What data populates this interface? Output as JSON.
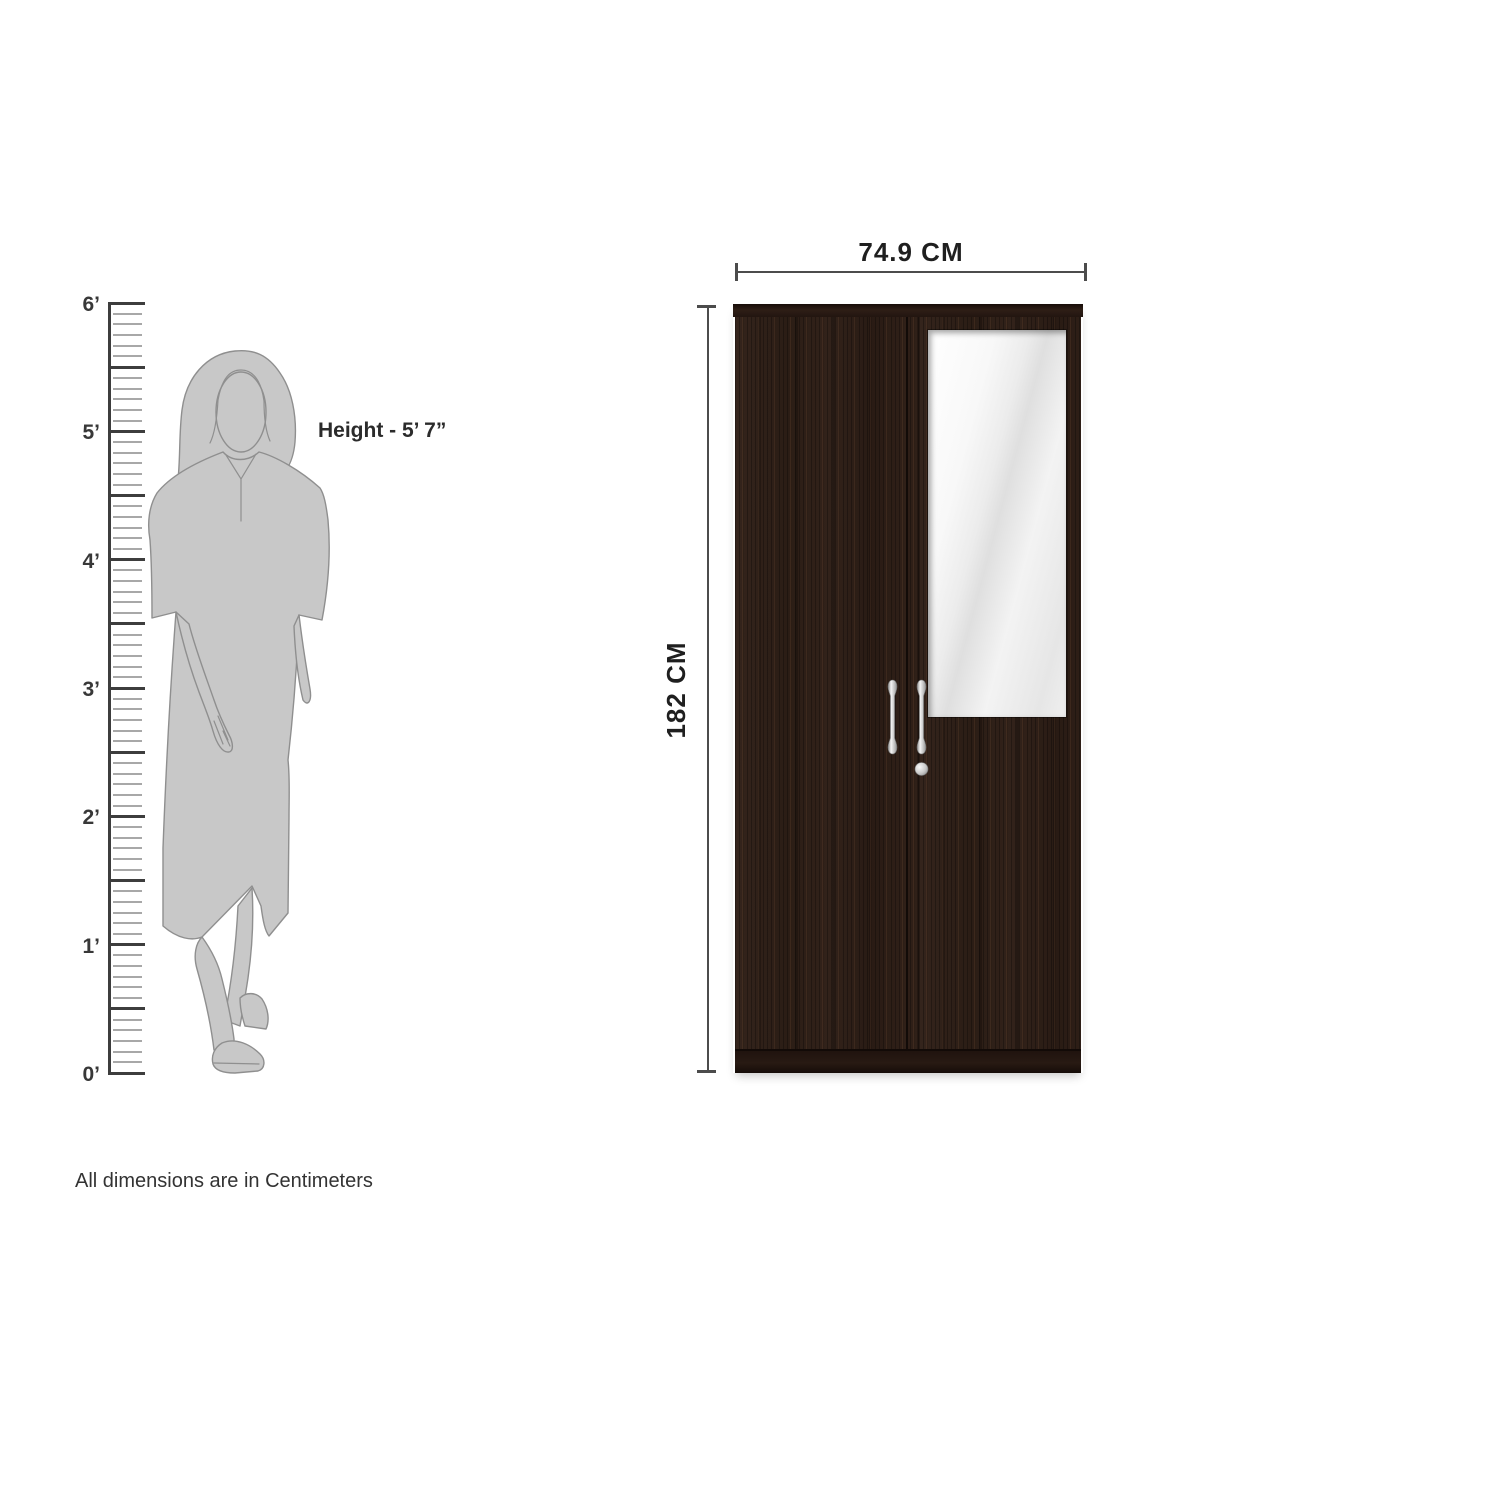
{
  "scale_reference": {
    "ruler": {
      "foot_labels": [
        "6’",
        "5’",
        "4’",
        "3’",
        "2’",
        "1’",
        "0’"
      ],
      "minor_ticks_per_half_foot": 5
    },
    "person": {
      "figure": "woman-line-art-silhouette",
      "height_label": "Height - 5’ 7”"
    }
  },
  "product_diagram": {
    "item": "two-door-wardrobe-with-mirror",
    "width_dimension": "74.9 CM",
    "height_dimension": "182 CM"
  },
  "footnote": "All dimensions are in Centimeters",
  "colors": {
    "wood": "#2d1e17",
    "crown": "#221510",
    "dimension_line": "#4c4c4c",
    "figure_fill": "#c8c8c8",
    "figure_outline": "#8f8f8f",
    "mirror": "#efefef",
    "handle_silver": "#d6d6d6",
    "text": "#2b2b2b"
  }
}
